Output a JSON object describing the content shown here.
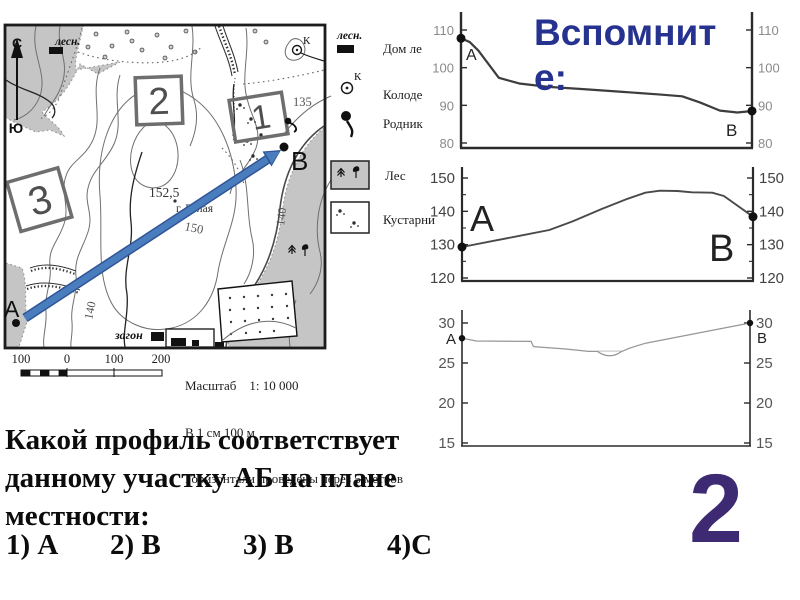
{
  "slide": {
    "title": "Вспомните:",
    "number": "2",
    "question": {
      "lines": [
        "Какой профиль соответствует",
        "данному участку АБ на плане",
        "местности:"
      ],
      "options": [
        "1) А",
        "2) В",
        "3) В",
        "4)С"
      ]
    }
  },
  "map": {
    "compass": {
      "north": "С",
      "south": "Ю"
    },
    "labels": {
      "forester_abbr": "лесн.",
      "area_1": "1",
      "area_2": "2",
      "area_3": "3",
      "spot_height": "152,5",
      "mountain": "г. Белая",
      "contour_150": "150",
      "contour_140_left": "140",
      "contour_140_right": "140",
      "elevation_135": "135",
      "well_letter": "К",
      "corral": "загон",
      "point_a": "А",
      "point_b": "В"
    },
    "scale_bar": [
      "100",
      "0",
      "100",
      "200"
    ],
    "scale_text": [
      "Масштаб    1: 10 000",
      "В 1 см 100 м",
      "Горизонтали проведены через 5 метров"
    ]
  },
  "legend": {
    "items": [
      {
        "symbol": "forester-house",
        "abbr": "лесн.",
        "label": "Дом ле"
      },
      {
        "symbol": "well",
        "letter": "К",
        "label": "Колоде"
      },
      {
        "symbol": "spring",
        "label": "Родник"
      },
      {
        "symbol": "forest",
        "label": "Лес"
      },
      {
        "symbol": "shrubs",
        "label": "Кустарни"
      }
    ]
  },
  "chart_data": [
    {
      "type": "line",
      "title": "profile-option-1",
      "start_label": "А",
      "end_label": "В",
      "start_value": 108,
      "end_value": 88,
      "ylim": [
        80,
        110
      ],
      "yticks": [
        110,
        100,
        90,
        80
      ],
      "grid": false,
      "x_unit": "fraction of АВ distance",
      "points": [
        [
          0,
          107.8
        ],
        [
          0.03,
          106.8
        ],
        [
          0.06,
          104.5
        ],
        [
          0.13,
          97.3
        ],
        [
          0.2,
          95.8
        ],
        [
          0.3,
          94.9
        ],
        [
          0.42,
          94.3
        ],
        [
          0.55,
          93.6
        ],
        [
          0.68,
          92.9
        ],
        [
          0.76,
          92.4
        ],
        [
          0.82,
          90.8
        ],
        [
          0.89,
          88.6
        ],
        [
          0.95,
          88.1
        ],
        [
          1,
          88.5
        ]
      ]
    },
    {
      "type": "line",
      "title": "profile-option-2",
      "start_label": "А",
      "end_label": "В",
      "start_value": 129,
      "end_value": 138,
      "ylim": [
        120,
        150
      ],
      "yticks": [
        150,
        140,
        130,
        120
      ],
      "minor_ticks": [
        145,
        135,
        125
      ],
      "grid": false,
      "x_unit": "fraction of АВ distance",
      "points": [
        [
          0,
          129.3
        ],
        [
          0.1,
          131
        ],
        [
          0.2,
          132.7
        ],
        [
          0.3,
          134.4
        ],
        [
          0.38,
          137
        ],
        [
          0.48,
          140.7
        ],
        [
          0.57,
          143.8
        ],
        [
          0.63,
          145.6
        ],
        [
          0.68,
          146.2
        ],
        [
          0.74,
          146.1
        ],
        [
          0.79,
          145.7
        ],
        [
          0.86,
          145.6
        ],
        [
          0.9,
          144.6
        ],
        [
          1,
          138.4
        ]
      ]
    },
    {
      "type": "line",
      "title": "profile-option-3",
      "start_label": "А",
      "end_label": "В",
      "start_value": 28,
      "end_value": 30,
      "ylim": [
        15,
        30
      ],
      "yticks": [
        30,
        25,
        20,
        15
      ],
      "grid": false,
      "x_unit": "fraction of АВ distance",
      "river_notch": {
        "from": 0.47,
        "to": 0.555,
        "level": 26.45,
        "depth": 0.55
      },
      "points": [
        [
          0,
          28.1
        ],
        [
          0.05,
          27.75
        ],
        [
          0.24,
          27.7
        ],
        [
          0.248,
          27.05
        ],
        [
          0.36,
          26.75
        ],
        [
          0.44,
          26.45
        ],
        [
          0.555,
          26.45
        ],
        [
          0.585,
          26.9
        ],
        [
          0.635,
          27.45
        ],
        [
          1,
          30
        ]
      ]
    }
  ],
  "colors": {
    "title": "#26328f",
    "slide_number": "#3e2a72",
    "arrow_fill": "#4a7dbd",
    "arrow_edge": "#2f5597",
    "map_gray": "#c5c5c5",
    "contour": "#6f6f6f"
  }
}
